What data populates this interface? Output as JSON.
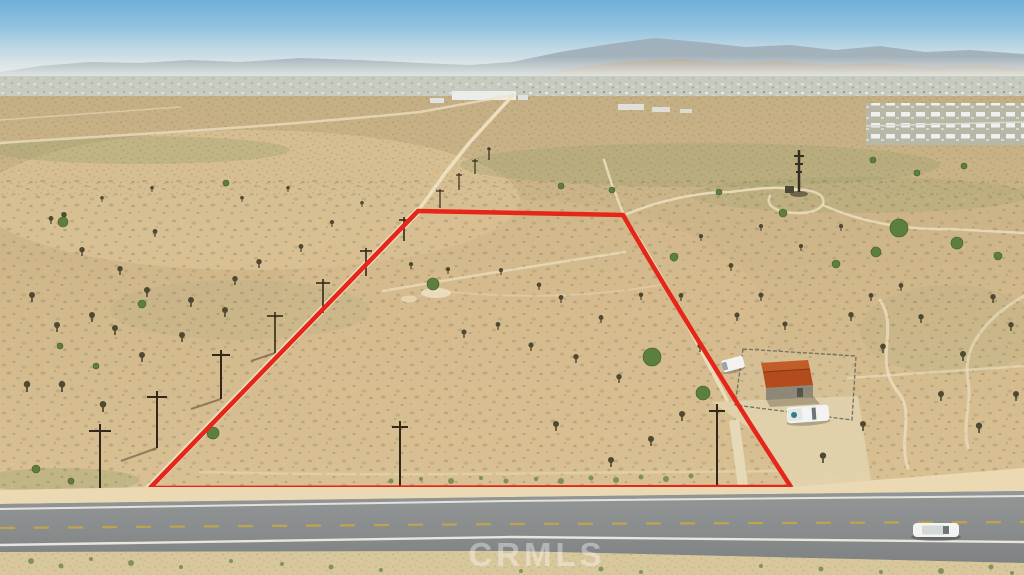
{
  "scene": {
    "type": "aerial-drone-photo",
    "description": "Aerial view of a vacant desert land parcel outlined in red, bordered by a paved two-lane highway at the bottom, with a small fenced utility shed compound, scattered Joshua trees, dirt paths, utility poles, distant town and hazy mountains under a blue sky",
    "watermark": "CRMLS"
  },
  "colors": {
    "boundary": "#e62619",
    "sky_top": "#6fb0d8",
    "sky_haze": "#e4e9e6",
    "mountains_far": "#9fadb6",
    "mountains_near": "#b3a28c",
    "desert": "#d2b98c",
    "dirt_path": "#efe3c4",
    "road": "#8b8e8f",
    "lane_white": "#eceae2",
    "lane_yellow": "#c9a83f",
    "shed_roof": "#b24b1d",
    "vehicle_white": "#f3f4f1",
    "vegetation_green": "#5c7f3e"
  },
  "objects": {
    "parcel_boundary": "red outlined trapezoid lot",
    "highway": "two-lane paved road with yellow dashed centerline",
    "shed": "small building with rust-red gable roof inside chain-link fence",
    "pickup_trucks": "two white utility trucks parked by the shed",
    "car_on_road": "white vehicle driving on highway",
    "tower": "dark lattice utility tower on dirt clearing",
    "housing_development": "rows of white rooftops at upper right",
    "utility_poles": "line of wooden power poles along dirt road"
  }
}
